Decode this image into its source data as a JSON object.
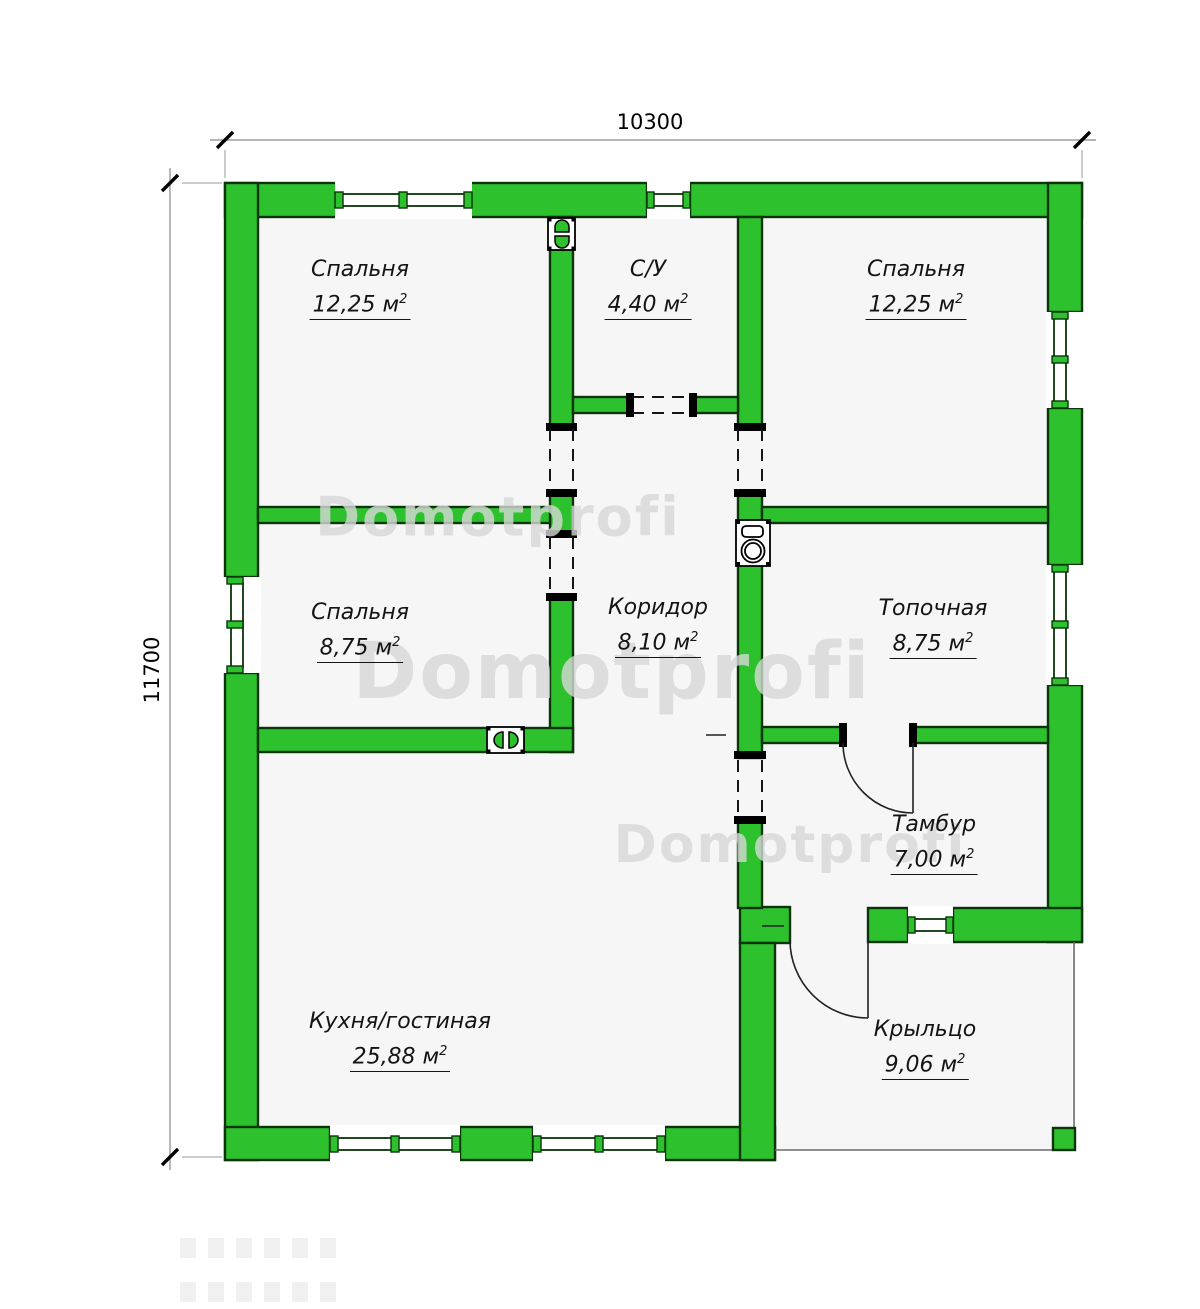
{
  "plan": {
    "watermark_text": "Domotprofi",
    "dimensions": {
      "top": "10300",
      "left": "11700"
    },
    "rooms": [
      {
        "label": "Спальня",
        "area": "12,25 м",
        "sup": "2"
      },
      {
        "label": "С/У",
        "area": "4,40 м",
        "sup": "2"
      },
      {
        "label": "Спальня",
        "area": "12,25 м",
        "sup": "2"
      },
      {
        "label": "Спальня",
        "area": "8,75 м",
        "sup": "2"
      },
      {
        "label": "Коридор",
        "area": "8,10 м",
        "sup": "2"
      },
      {
        "label": "Топочная",
        "area": "8,75 м",
        "sup": "2"
      },
      {
        "label": "Кухня/гостиная",
        "area": "25,88 м",
        "sup": "2"
      },
      {
        "label": "Тамбур",
        "area": "7,00 м",
        "sup": "2"
      },
      {
        "label": "Крыльцо",
        "area": "9,06 м",
        "sup": "2"
      }
    ],
    "icons": [
      {
        "name": "chimney-icon"
      },
      {
        "name": "boiler-icon"
      },
      {
        "name": "ventilation-icon"
      }
    ],
    "colors": {
      "wall_green": "#2dc22d",
      "wall_outline": "#0a340a",
      "floor": "#f6f6f6",
      "watermark": "#d8d8d8"
    }
  }
}
